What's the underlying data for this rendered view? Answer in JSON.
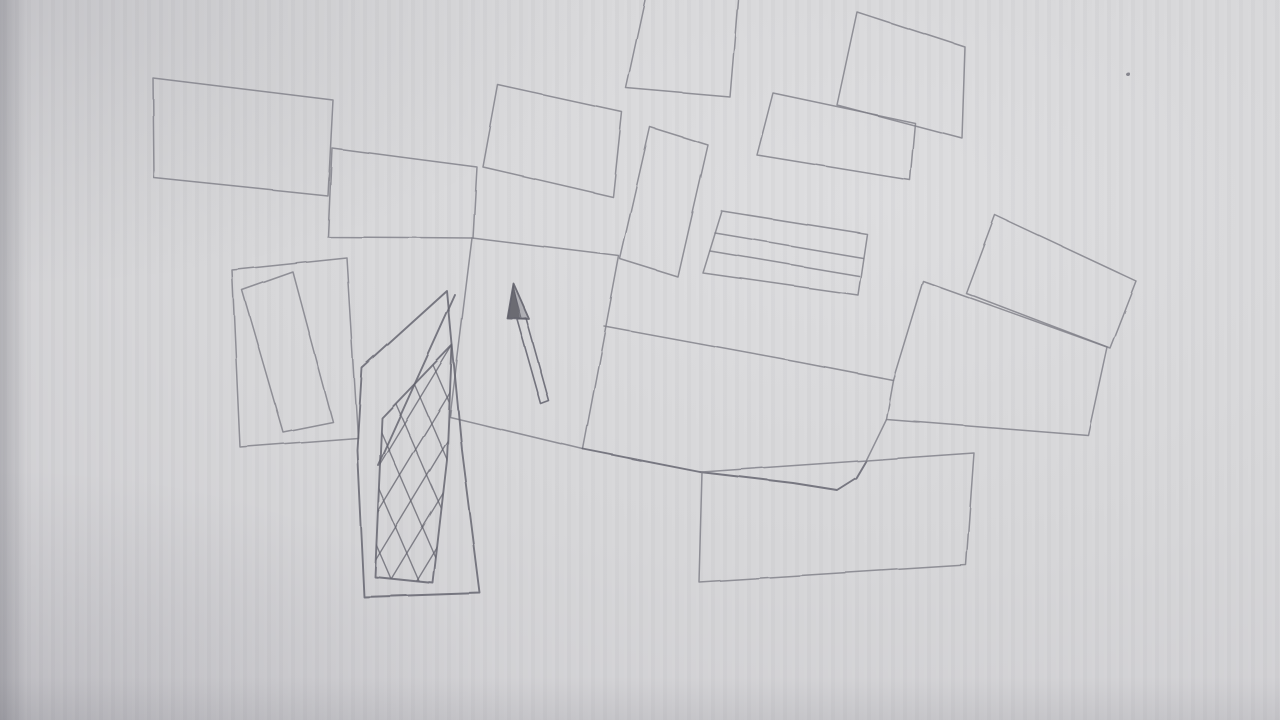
{
  "meta": {
    "description": "photo of a freehand pencil sketch: scattered tilted rectangles, a striped rectangle, a cross-hatched tall frame, and a small paintbrush drawn inside the large central rectangle",
    "canvas": {
      "width": 1280,
      "height": 720
    }
  },
  "paper": {
    "base_color": "#d2d2d4",
    "vignette_light": "#dddddf",
    "vignette_dark": "#c3c3c7",
    "left_edge_shadow": "rgba(88,88,98,0.28)"
  },
  "pencil": {
    "color": "#7f7f88",
    "dark_color": "#62626c",
    "width": 1.5,
    "dark_width": 1.9,
    "opacity": 0.82
  },
  "sketch": {
    "strokes": [
      {
        "name": "rect-top-left",
        "closed": true,
        "points": [
          [
            153,
            78
          ],
          [
            333,
            100
          ],
          [
            328,
            196
          ],
          [
            154,
            178
          ]
        ]
      },
      {
        "name": "rect-left-mid",
        "closed": true,
        "points": [
          [
            332,
            148
          ],
          [
            477,
            167
          ],
          [
            473,
            238
          ],
          [
            328,
            237
          ]
        ]
      },
      {
        "name": "rect-center-upper",
        "closed": true,
        "points": [
          [
            498,
            85
          ],
          [
            622,
            112
          ],
          [
            613,
            197
          ],
          [
            483,
            167
          ]
        ]
      },
      {
        "name": "rect-top-center",
        "closed": false,
        "points": [
          [
            645,
            0
          ],
          [
            626,
            88
          ],
          [
            730,
            97
          ],
          [
            738,
            0
          ]
        ]
      },
      {
        "name": "rect-top-right",
        "closed": true,
        "points": [
          [
            857,
            12
          ],
          [
            965,
            47
          ],
          [
            962,
            138
          ],
          [
            837,
            105
          ]
        ]
      },
      {
        "name": "rect-top-mid-wide",
        "closed": true,
        "points": [
          [
            773,
            93
          ],
          [
            915,
            123
          ],
          [
            910,
            180
          ],
          [
            757,
            155
          ]
        ]
      },
      {
        "name": "rect-narrow-tall",
        "closed": true,
        "points": [
          [
            650,
            127
          ],
          [
            708,
            145
          ],
          [
            678,
            277
          ],
          [
            620,
            259
          ]
        ]
      },
      {
        "name": "rect-striped",
        "closed": true,
        "points": [
          [
            722,
            211
          ],
          [
            867,
            234
          ],
          [
            858,
            295
          ],
          [
            703,
            273
          ]
        ]
      },
      {
        "name": "striped-inner-line-1",
        "closed": false,
        "points": [
          [
            715,
            233
          ],
          [
            863,
            258
          ]
        ]
      },
      {
        "name": "striped-inner-line-2",
        "closed": false,
        "points": [
          [
            710,
            251
          ],
          [
            859,
            276
          ]
        ]
      },
      {
        "name": "rect-center-main",
        "closed": true,
        "points": [
          [
            472,
            238
          ],
          [
            619,
            256
          ],
          [
            583,
            449
          ],
          [
            450,
            417
          ]
        ]
      },
      {
        "name": "long-bottom-stroke",
        "closed": false,
        "dark": true,
        "points": [
          [
            583,
            449
          ],
          [
            700,
            472
          ],
          [
            793,
            483
          ],
          [
            837,
            490
          ],
          [
            856,
            478
          ],
          [
            866,
            461
          ]
        ]
      },
      {
        "name": "mid-diagonal-line",
        "closed": false,
        "points": [
          [
            604,
            326
          ],
          [
            800,
            362
          ],
          [
            893,
            380
          ]
        ]
      },
      {
        "name": "rect-bottom-center",
        "closed": true,
        "points": [
          [
            702,
            472
          ],
          [
            974,
            453
          ],
          [
            966,
            565
          ],
          [
            699,
            582
          ]
        ]
      },
      {
        "name": "rect-right-upper",
        "closed": true,
        "points": [
          [
            995,
            215
          ],
          [
            1136,
            281
          ],
          [
            1110,
            348
          ],
          [
            966,
            293
          ]
        ]
      },
      {
        "name": "rect-right-lower",
        "closed": true,
        "points": [
          [
            923,
            281
          ],
          [
            1107,
            347
          ],
          [
            1088,
            435
          ],
          [
            886,
            419
          ],
          [
            893,
            380
          ]
        ]
      },
      {
        "name": "right-lower-overshoot",
        "closed": false,
        "points": [
          [
            886,
            419
          ],
          [
            866,
            460
          ]
        ]
      },
      {
        "name": "rect-left-frame",
        "closed": true,
        "points": [
          [
            232,
            270
          ],
          [
            347,
            258
          ],
          [
            358,
            438
          ],
          [
            240,
            447
          ]
        ]
      },
      {
        "name": "rect-left-inner-bar",
        "closed": true,
        "points": [
          [
            242,
            290
          ],
          [
            293,
            272
          ],
          [
            333,
            422
          ],
          [
            283,
            432
          ]
        ]
      },
      {
        "name": "hatch-frame-outer",
        "closed": true,
        "dark": true,
        "points": [
          [
            362,
            368
          ],
          [
            447,
            291
          ],
          [
            462,
            450
          ],
          [
            480,
            593
          ],
          [
            364,
            597
          ],
          [
            357,
            450
          ]
        ]
      },
      {
        "name": "hatch-frame-inner",
        "closed": true,
        "dark": true,
        "points": [
          [
            382,
            418
          ],
          [
            452,
            345
          ],
          [
            447,
            460
          ],
          [
            433,
            583
          ],
          [
            375,
            577
          ]
        ]
      },
      {
        "name": "hatch-long-diagonal",
        "closed": false,
        "dark": true,
        "points": [
          [
            378,
            465
          ],
          [
            455,
            295
          ]
        ]
      }
    ],
    "hatch": {
      "region": [
        [
          382,
          418
        ],
        [
          452,
          345
        ],
        [
          447,
          460
        ],
        [
          433,
          583
        ],
        [
          375,
          577
        ]
      ],
      "y_top": 335,
      "y_bottom": 600,
      "families": [
        {
          "slope": 2.3,
          "x_start": 285,
          "x_end": 470,
          "step": 27
        },
        {
          "slope": -1.65,
          "x_start": 350,
          "x_end": 640,
          "step": 27
        }
      ]
    },
    "brush": {
      "head_outline": [
        [
          513,
          283
        ],
        [
          507,
          318
        ],
        [
          529,
          319
        ]
      ],
      "head_shade": [
        [
          513,
          283
        ],
        [
          507,
          318
        ],
        [
          520,
          318
        ]
      ],
      "head_inner_line": [
        [
          514,
          292
        ],
        [
          521,
          318
        ]
      ],
      "handle": [
        [
          517,
          319
        ],
        [
          526,
          318
        ],
        [
          549,
          401
        ],
        [
          541,
          404
        ]
      ],
      "head_fill_color": "rgba(118,118,126,0.45)",
      "shade_fill_color": "rgba(78,78,88,0.85)"
    },
    "stray_dot": {
      "x": 1128,
      "y": 74,
      "r": 2
    }
  }
}
